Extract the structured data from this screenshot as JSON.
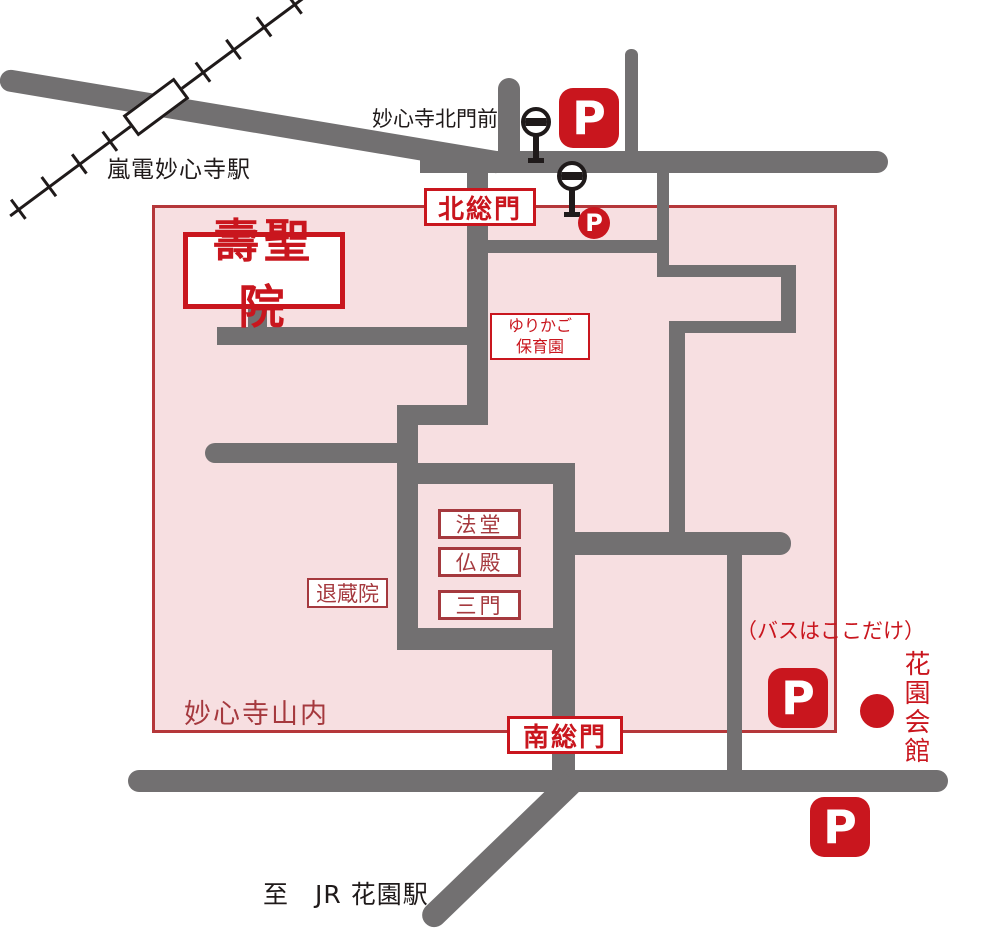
{
  "colors": {
    "road": "#727071",
    "pink": "#f7dfe1",
    "pink_border": "#b5373a",
    "crimson": "#c9161e",
    "muted_red": "#a5393e",
    "ink": "#1f1a1a",
    "white": "#ffffff"
  },
  "labels": {
    "randen_station": "嵐電妙心寺駅",
    "bus_stop_north": "妙心寺北門前",
    "north_gate": "北総門",
    "south_gate": "南総門",
    "temple": "壽聖院",
    "nursery_line1": "ゆりかご",
    "nursery_line2": "保育園",
    "hatto": "法堂",
    "butsuden": "仏殿",
    "sanmon": "三門",
    "taizoin": "退蔵院",
    "precinct": "妙心寺山内",
    "bus_note": "（バスはここだけ）",
    "hanazono_hall": "花園会館",
    "to_jr": "至　JR 花園駅",
    "parking_symbol": "P"
  },
  "icons": {
    "parking": "parking-sign",
    "bus_stop": "bus-stop-sign",
    "station_marker": "railway-station-box",
    "bus_boarding_point": "red-dot"
  }
}
